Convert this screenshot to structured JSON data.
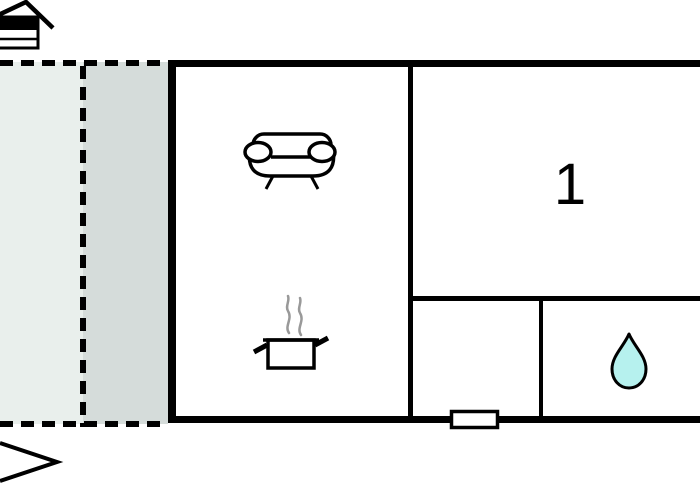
{
  "floorplan": {
    "rooms": {
      "bedroom": {
        "label": "1"
      }
    },
    "symbols": {
      "house_level": "house-level-icon",
      "sofa": "sofa-icon",
      "cooking_pot": "cooking-pot-icon",
      "water_drop": "water-drop-icon",
      "north_arrow": "north-arrow-icon",
      "window": "window-symbol"
    },
    "colors": {
      "wall": "#000000",
      "terrace_light": "#e9efec",
      "terrace_shaded": "#d5dcda",
      "water_drop_fill": "#b6f1ee",
      "steam": "#999999",
      "background": "#ffffff"
    }
  }
}
